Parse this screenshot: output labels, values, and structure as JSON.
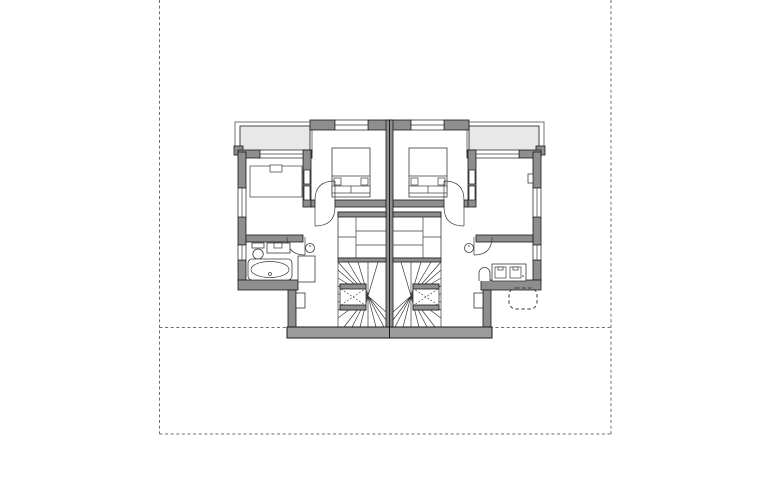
{
  "drawing": {
    "name": "floor-plan",
    "kind": "architectural-floor-plan",
    "units": 2,
    "mirrored": true
  },
  "colors": {
    "wall": "#8e8e8e",
    "balcony": "#e8e8e8",
    "baseplate": "#9c9c9c",
    "line": "#1a1a1a",
    "thin": "#3a3a3a",
    "boundary": "#6e6e6e",
    "paper": "#ffffff"
  },
  "icons": {
    "bed": "double-bed-plan-symbol",
    "bathtub": "bathtub-plan-symbol",
    "toilet": "toilet-plan-symbol",
    "washbasin": "washbasin-plan-symbol",
    "stair": "winder-stair-plan-symbol",
    "door": "door-swing-arc-symbol",
    "boundary": "dashed-site-boundary-line"
  }
}
